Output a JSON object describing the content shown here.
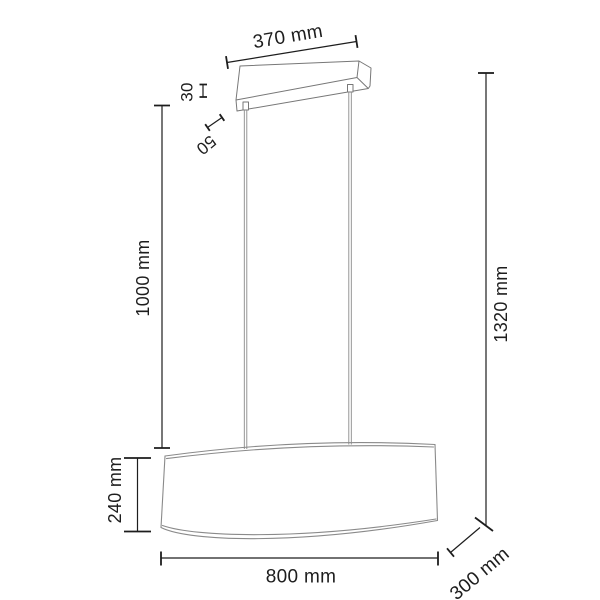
{
  "figure": {
    "type": "product-dimension-diagram",
    "subject": "oval drum pendant lamp with rectangular ceiling canopy and two suspension cables",
    "background_color": "#ffffff",
    "dimension_color": "#1d1d1d",
    "shade_line_color": "#8a8a8a",
    "canopy_line_color": "#777777"
  },
  "dimensions": [
    {
      "id": "canopy-width",
      "label": "370 mm"
    },
    {
      "id": "canopy-height",
      "label": "30"
    },
    {
      "id": "connector-length",
      "label": "50"
    },
    {
      "id": "cable-length",
      "label": "1000 mm"
    },
    {
      "id": "total-height",
      "label": "1320 mm"
    },
    {
      "id": "shade-height",
      "label": "240 mm"
    },
    {
      "id": "shade-width",
      "label": "800 mm"
    },
    {
      "id": "shade-depth",
      "label": "300 mm"
    }
  ]
}
